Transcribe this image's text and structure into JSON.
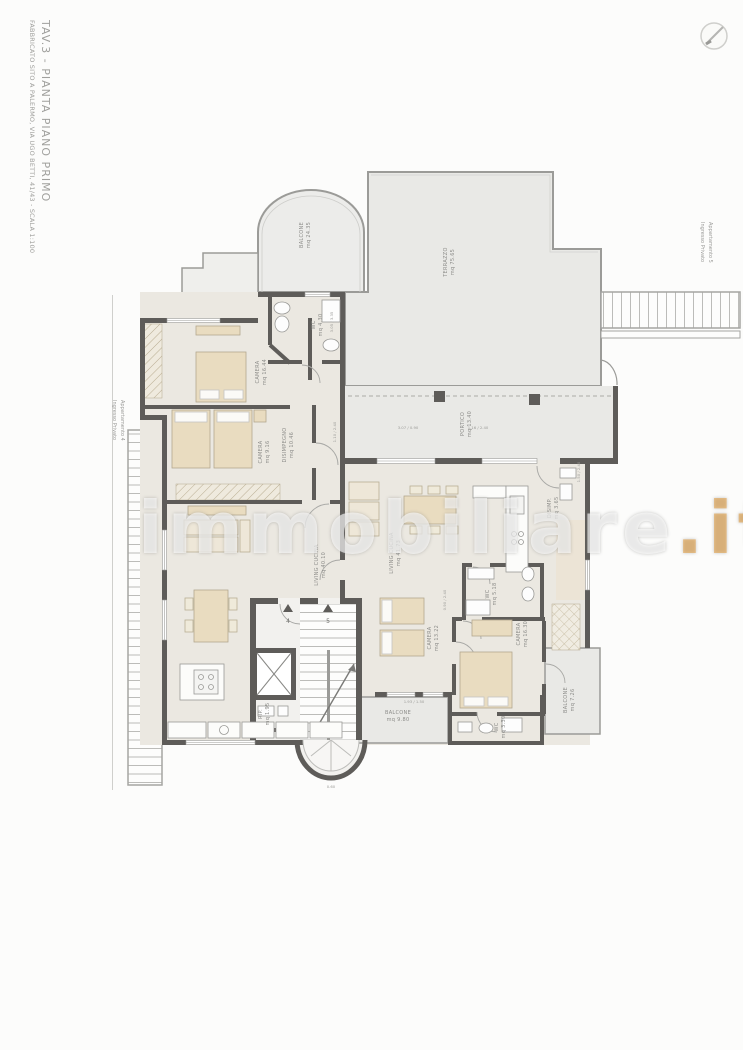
{
  "title_block": {
    "title": "TAV.3 - PIANTA PIANO PRIMO",
    "subtitle": "FABBRICATO SITO A PALERMO, VIA UGO BETTI, 41/43 - SCALA 1:100"
  },
  "watermark": {
    "name": "immobiliare",
    "tld": ".it",
    "tld_color": "#e2a24b"
  },
  "icons": {
    "compass": "north-compass-icon"
  },
  "entrances": {
    "apt4_line1": "Ingresso Privato",
    "apt4_line2": "Appartamento 4",
    "apt5_line1": "Ingresso Privato",
    "apt5_line2": "Appartamento 5"
  },
  "stair_core": {
    "door4": "4",
    "door5": "5"
  },
  "rooms": [
    {
      "id": "terrazzo",
      "name": "TERRAZZO",
      "area": "mq 75.65"
    },
    {
      "id": "balcone_nw",
      "name": "BALCONE",
      "area": "mq 24.35"
    },
    {
      "id": "portico",
      "name": "PORTICO",
      "area": "mq 13.40"
    },
    {
      "id": "camera_nw",
      "name": "CAMERA",
      "area": "mq 16.44"
    },
    {
      "id": "wc_top",
      "name": "WC",
      "area": "mq 4.30"
    },
    {
      "id": "camera_w",
      "name": "CAMERA",
      "area": "mq 9.16"
    },
    {
      "id": "living4",
      "name": "LIVING CUCINA",
      "area": "mq 40.10"
    },
    {
      "id": "living5",
      "name": "LIVING CUCINA",
      "area": "mq 41.73"
    },
    {
      "id": "disimpegno4",
      "name": "DISIMPEGNO",
      "area": "mq 10.46"
    },
    {
      "id": "wc_mid",
      "name": "WC",
      "area": "mq 5.18"
    },
    {
      "id": "camera_c",
      "name": "CAMERA",
      "area": "mq 13.22"
    },
    {
      "id": "camera_e",
      "name": "CAMERA",
      "area": "mq 16.30"
    },
    {
      "id": "balcone_e",
      "name": "BALCONE",
      "area": "mq 7.26"
    },
    {
      "id": "balcone_s",
      "name": "BALCONE",
      "area": "mq 9.80"
    },
    {
      "id": "wc_s",
      "name": "WC",
      "area": "mq 3.30"
    },
    {
      "id": "rip",
      "name": "RIP.",
      "area": "mq 1.95"
    },
    {
      "id": "disimp5",
      "name": "DISIMP.",
      "area": "mq 3.65"
    }
  ],
  "dims": [
    "3.05 / 3.35",
    "1.10 / 2.40",
    "3.07 / 0.90",
    "1.16 / 2.40",
    "0.90 / 2.40",
    "1.93 / 1.50",
    "0.60",
    "1.50 / 2.40"
  ],
  "colors": {
    "wall": "#5e5c59",
    "interior": "#ebe8e1",
    "outdoor": "#e9e9e6",
    "furniture": "#e9dcc0",
    "watermark_accent": "#e2a24b"
  }
}
